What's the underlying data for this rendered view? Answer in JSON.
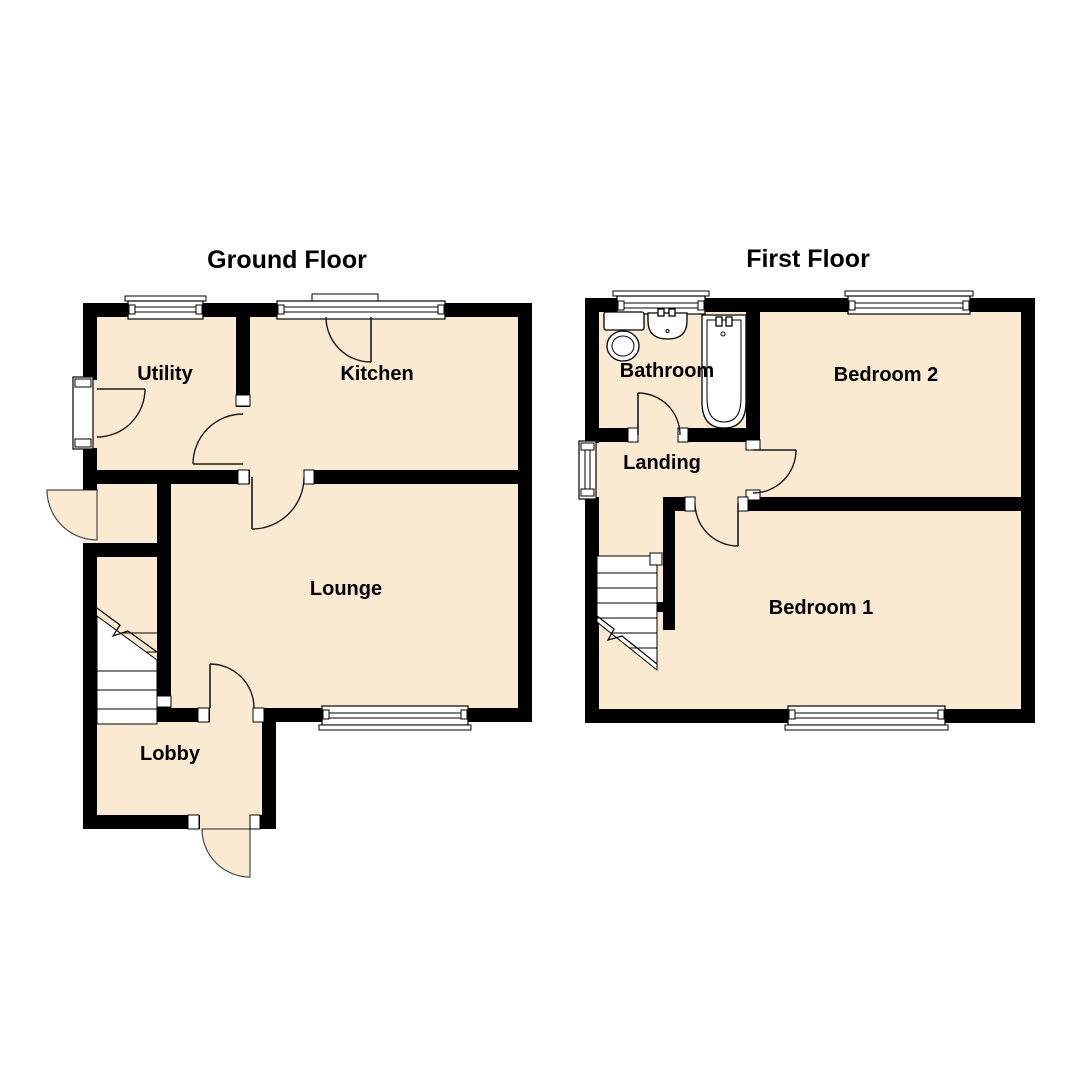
{
  "palette": {
    "background": "#ffffff",
    "wall_color": "#000000",
    "floor_fill": "#faead2",
    "line_color": "#1a1a1a"
  },
  "ground_floor": {
    "title": "Ground Floor",
    "rooms": [
      {
        "name": "Utility"
      },
      {
        "name": "Kitchen"
      },
      {
        "name": "Lounge"
      },
      {
        "name": "Lobby"
      }
    ],
    "features": {
      "staircase": "stairs",
      "windows": [
        "utility-window",
        "kitchen-window",
        "lounge-window"
      ],
      "doors": [
        "utility-external-door",
        "kitchen-back-door",
        "utility-inner-door",
        "kitchen-lounge-door",
        "lounge-lobby-door",
        "front-door",
        "lobby-external-door"
      ]
    }
  },
  "first_floor": {
    "title": "First Floor",
    "rooms": [
      {
        "name": "Bathroom"
      },
      {
        "name": "Bedroom 2"
      },
      {
        "name": "Landing"
      },
      {
        "name": "Bedroom 1"
      }
    ],
    "fixtures": [
      "toilet",
      "sink",
      "bath"
    ],
    "features": {
      "staircase": "stairs",
      "windows": [
        "bathroom-window",
        "bedroom-2-window",
        "bedroom-1-window",
        "landing-window"
      ],
      "doors": [
        "bathroom-door",
        "bedroom-2-door",
        "bedroom-1-door"
      ]
    }
  }
}
